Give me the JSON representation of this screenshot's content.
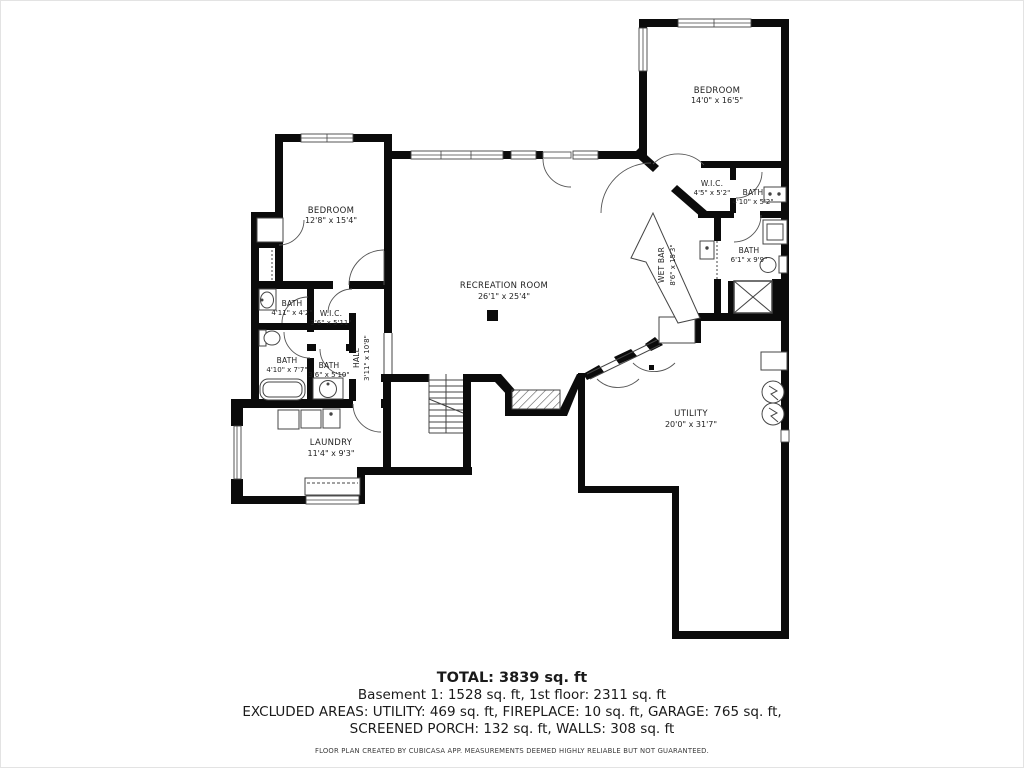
{
  "rooms": {
    "bedroom_ne": {
      "label": "BEDROOM",
      "dims": "14'0\" x 16'5\""
    },
    "bedroom_w": {
      "label": "BEDROOM",
      "dims": "12'8\" x 15'4\""
    },
    "recreation": {
      "label": "RECREATION ROOM",
      "dims": "26'1\" x 25'4\""
    },
    "wet_bar": {
      "label": "WET BAR",
      "dims": "8'6\" x 15'3\""
    },
    "wic_ne": {
      "label": "W.I.C.",
      "dims": "4'5\" x 5'2\""
    },
    "bath_ne": {
      "label": "BATH",
      "dims": "4'10\" x 5'2\""
    },
    "bath_e": {
      "label": "BATH",
      "dims": "6'1\" x 9'9\""
    },
    "bath_nw": {
      "label": "BATH",
      "dims": "4'11\" x 4'2\""
    },
    "wic_w": {
      "label": "W.I.C.",
      "dims": "3'6\" x 5'11\""
    },
    "bath_w": {
      "label": "BATH",
      "dims": "4'10\" x 7'7\""
    },
    "bath_sw": {
      "label": "BATH",
      "dims": "3'6\" x 5'10\""
    },
    "hall": {
      "label": "HALL",
      "dims": "3'11\" x 10'8\""
    },
    "laundry": {
      "label": "LAUNDRY",
      "dims": "11'4\" x 9'3\""
    },
    "utility": {
      "label": "UTILITY",
      "dims": "20'0\" x 31'7\""
    }
  },
  "summary": {
    "total": "TOTAL: 3839 sq. ft",
    "line2": "Basement 1: 1528 sq. ft, 1st floor: 2311 sq. ft",
    "line3": "EXCLUDED AREAS: UTILITY: 469 sq. ft, FIREPLACE: 10 sq. ft, GARAGE: 765 sq. ft,",
    "line4": "SCREENED PORCH: 132 sq. ft, WALLS: 308 sq. ft",
    "disclaimer": "FLOOR PLAN CREATED BY CUBICASA APP. MEASUREMENTS DEEMED HIGHLY RELIABLE BUT NOT GUARANTEED."
  },
  "colors": {
    "wall": "#0b0b0b",
    "line": "#444444",
    "background": "#ffffff"
  }
}
